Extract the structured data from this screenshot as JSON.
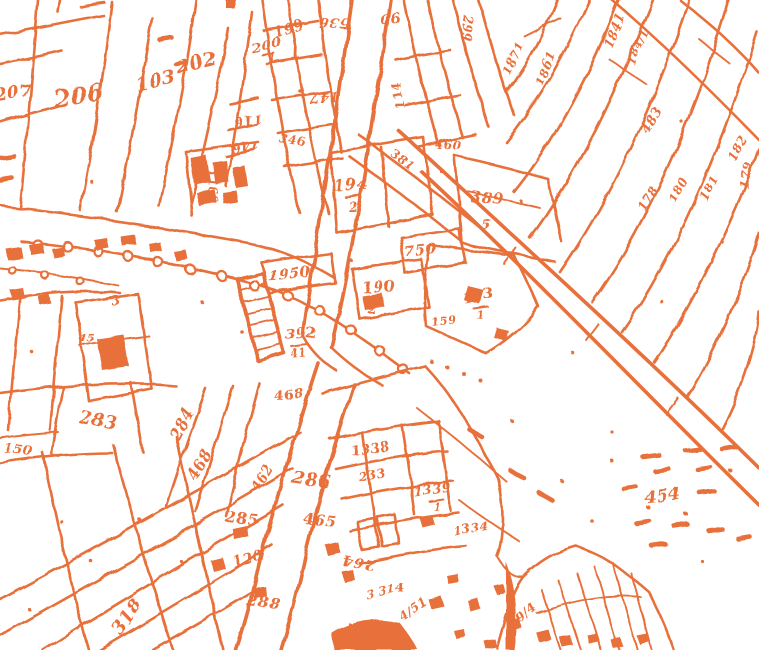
{
  "meta": {
    "title": "Scanned cadastral map sheet (binarized orange linework on white)",
    "background_color": "#ffffff",
    "ink_color": "#e8703a",
    "description": "Hand-drawn cadastral parcel map scan: parcel boundary linework, roads, building footprints, a tree/pole-lined road with circle symbols, hatched strips, and handwritten parcel numbers at various rotations."
  },
  "map": {
    "symbols": {
      "pole_circles": "small circles along road (tree/pole symbols)",
      "hatched_strip": "diagonally hatched narrow road strip near map centre",
      "building_footprints": "solid filled small rectangles",
      "smudge": "illegible heavy scribble reading approximately 454 with dashes around it"
    },
    "parcel_labels": [
      {
        "text": "206",
        "x": 80,
        "y": 104,
        "rot": -8,
        "size": 24
      },
      {
        "text": "103",
        "x": 157,
        "y": 87,
        "rot": -12,
        "size": 19
      },
      {
        "text": "202",
        "x": 198,
        "y": 69,
        "rot": -14,
        "size": 19
      },
      {
        "text": "207",
        "x": 14,
        "y": 98,
        "rot": -8,
        "size": 17
      },
      {
        "text": "200",
        "x": 268,
        "y": 50,
        "rot": -15,
        "size": 14
      },
      {
        "text": "1",
        "x": 273,
        "y": 64,
        "rot": 0,
        "size": 12
      },
      {
        "text": "199",
        "x": 290,
        "y": 33,
        "rot": -15,
        "size": 14
      },
      {
        "text": "116",
        "x": 247,
        "y": 116,
        "rot": 172,
        "size": 13
      },
      {
        "text": "146",
        "x": 245,
        "y": 142,
        "rot": 172,
        "size": 13
      },
      {
        "text": "58",
        "x": 196,
        "y": 170,
        "rot": 84,
        "size": 11
      },
      {
        "text": "1166",
        "x": 208,
        "y": 186,
        "rot": 84,
        "size": 12
      },
      {
        "text": "536",
        "x": 334,
        "y": 18,
        "rot": 183,
        "size": 14
      },
      {
        "text": "90",
        "x": 390,
        "y": 14,
        "rot": 174,
        "size": 14
      },
      {
        "text": "147",
        "x": 324,
        "y": 93,
        "rot": 177,
        "size": 14
      },
      {
        "text": "114",
        "x": 402,
        "y": 94,
        "rot": -102,
        "size": 13
      },
      {
        "text": "299",
        "x": 463,
        "y": 28,
        "rot": 93,
        "size": 12
      },
      {
        "text": "346",
        "x": 292,
        "y": 144,
        "rot": 8,
        "size": 12
      },
      {
        "text": "194",
        "x": 351,
        "y": 190,
        "rot": -4,
        "size": 16
      },
      {
        "text": "2",
        "x": 353,
        "y": 211,
        "rot": 0,
        "size": 13
      },
      {
        "text": "381",
        "x": 400,
        "y": 163,
        "rot": 37,
        "size": 12
      },
      {
        "text": "460",
        "x": 448,
        "y": 149,
        "rot": 4,
        "size": 12
      },
      {
        "text": "389",
        "x": 487,
        "y": 203,
        "rot": 4,
        "size": 15
      },
      {
        "text": "5",
        "x": 486,
        "y": 230,
        "rot": 0,
        "size": 15
      },
      {
        "text": "750",
        "x": 421,
        "y": 255,
        "rot": -6,
        "size": 15
      },
      {
        "text": "1950",
        "x": 290,
        "y": 279,
        "rot": -5,
        "size": 15
      },
      {
        "text": "190",
        "x": 379,
        "y": 292,
        "rot": -3,
        "size": 15
      },
      {
        "text": "2",
        "x": 372,
        "y": 313,
        "rot": 0,
        "size": 12
      },
      {
        "text": "392",
        "x": 301,
        "y": 338,
        "rot": -4,
        "size": 14
      },
      {
        "text": "41",
        "x": 299,
        "y": 357,
        "rot": -4,
        "size": 11
      },
      {
        "text": "193",
        "x": 479,
        "y": 300,
        "rot": -12,
        "size": 14
      },
      {
        "text": "1",
        "x": 481,
        "y": 319,
        "rot": 0,
        "size": 11
      },
      {
        "text": "159",
        "x": 444,
        "y": 324,
        "rot": -10,
        "size": 11
      },
      {
        "text": "1871",
        "x": 517,
        "y": 60,
        "rot": -66,
        "size": 12
      },
      {
        "text": "1861",
        "x": 549,
        "y": 70,
        "rot": -66,
        "size": 12
      },
      {
        "text": "1841",
        "x": 618,
        "y": 32,
        "rot": -66,
        "size": 12
      },
      {
        "text": "184/1",
        "x": 641,
        "y": 48,
        "rot": -66,
        "size": 11
      },
      {
        "text": "483",
        "x": 655,
        "y": 122,
        "rot": -60,
        "size": 13
      },
      {
        "text": "182",
        "x": 741,
        "y": 150,
        "rot": -62,
        "size": 12
      },
      {
        "text": "181",
        "x": 713,
        "y": 190,
        "rot": -62,
        "size": 12
      },
      {
        "text": "180",
        "x": 682,
        "y": 192,
        "rot": -62,
        "size": 12
      },
      {
        "text": "179",
        "x": 750,
        "y": 176,
        "rot": -78,
        "size": 12
      },
      {
        "text": "178",
        "x": 651,
        "y": 200,
        "rot": -60,
        "size": 12
      },
      {
        "text": "3",
        "x": 116,
        "y": 305,
        "rot": 0,
        "size": 13
      },
      {
        "text": "45",
        "x": 87,
        "y": 342,
        "rot": 0,
        "size": 11
      },
      {
        "text": "283",
        "x": 97,
        "y": 426,
        "rot": 12,
        "size": 18
      },
      {
        "text": "150",
        "x": 18,
        "y": 454,
        "rot": 6,
        "size": 13
      },
      {
        "text": "284",
        "x": 186,
        "y": 426,
        "rot": -62,
        "size": 15
      },
      {
        "text": "468",
        "x": 204,
        "y": 467,
        "rot": -62,
        "size": 15
      },
      {
        "text": "462",
        "x": 266,
        "y": 480,
        "rot": -60,
        "size": 13
      },
      {
        "text": "468",
        "x": 290,
        "y": 399,
        "rot": -10,
        "size": 13
      },
      {
        "text": "318",
        "x": 132,
        "y": 620,
        "rot": -55,
        "size": 18
      },
      {
        "text": "285",
        "x": 241,
        "y": 523,
        "rot": 6,
        "size": 15
      },
      {
        "text": "465",
        "x": 319,
        "y": 525,
        "rot": 6,
        "size": 15
      },
      {
        "text": "286",
        "x": 311,
        "y": 486,
        "rot": 8,
        "size": 18
      },
      {
        "text": "120",
        "x": 249,
        "y": 563,
        "rot": -14,
        "size": 14
      },
      {
        "text": "288",
        "x": 263,
        "y": 607,
        "rot": 5,
        "size": 15
      },
      {
        "text": "264",
        "x": 359,
        "y": 558,
        "rot": 187,
        "size": 14
      },
      {
        "text": "1338",
        "x": 371,
        "y": 453,
        "rot": -8,
        "size": 13
      },
      {
        "text": "233",
        "x": 373,
        "y": 479,
        "rot": -12,
        "size": 12
      },
      {
        "text": "1339",
        "x": 433,
        "y": 494,
        "rot": -8,
        "size": 13
      },
      {
        "text": "1",
        "x": 438,
        "y": 511,
        "rot": 0,
        "size": 11
      },
      {
        "text": "1334",
        "x": 471,
        "y": 532,
        "rot": -10,
        "size": 12
      },
      {
        "text": "3 314",
        "x": 386,
        "y": 595,
        "rot": -10,
        "size": 12
      },
      {
        "text": "4/51",
        "x": 415,
        "y": 612,
        "rot": -34,
        "size": 12
      },
      {
        "text": "334",
        "x": 353,
        "y": 636,
        "rot": -70,
        "size": 12
      },
      {
        "text": "9/4",
        "x": 529,
        "y": 616,
        "rot": -40,
        "size": 12
      },
      {
        "text": "454",
        "x": 663,
        "y": 501,
        "rot": -6,
        "size": 17
      }
    ]
  }
}
